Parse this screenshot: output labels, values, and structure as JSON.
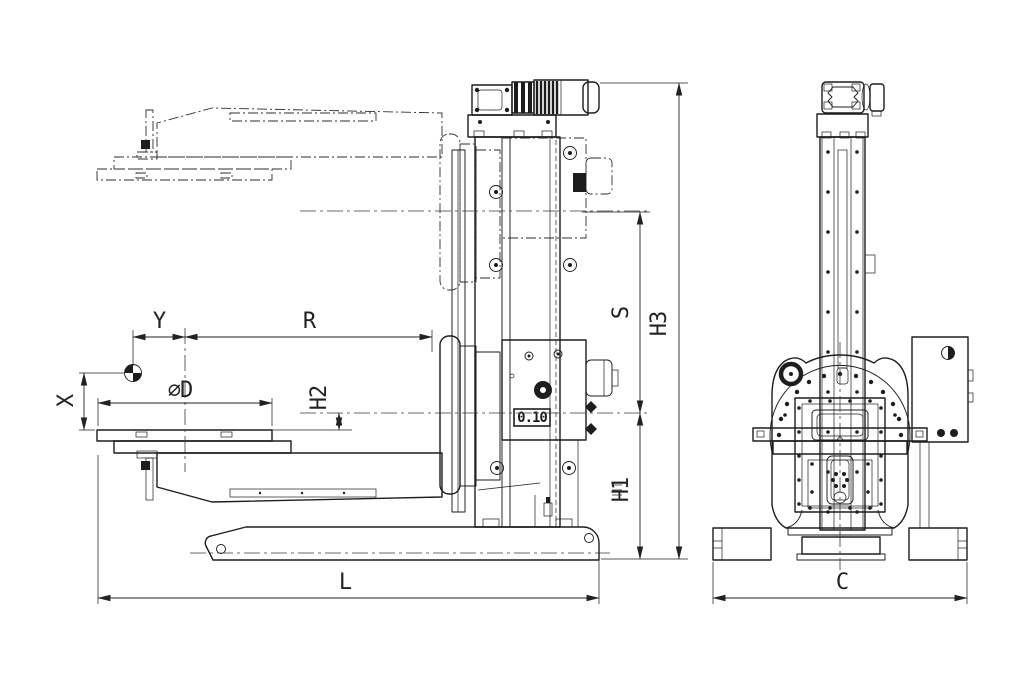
{
  "drawing": {
    "type": "technical-dimension-drawing",
    "views": {
      "left": "side-view",
      "right": "front-view"
    }
  },
  "dimensions": {
    "y": "Y",
    "r": "R",
    "x": "X",
    "d": "⌀D",
    "h2": "H2",
    "s": "S",
    "h3": "H3",
    "h1": "H1",
    "l": "L",
    "c": "C"
  },
  "annotations": {
    "tolerance": "0.10"
  },
  "colors": {
    "line": "#1d1d1d",
    "dim": "#222222",
    "background": "#ffffff"
  }
}
